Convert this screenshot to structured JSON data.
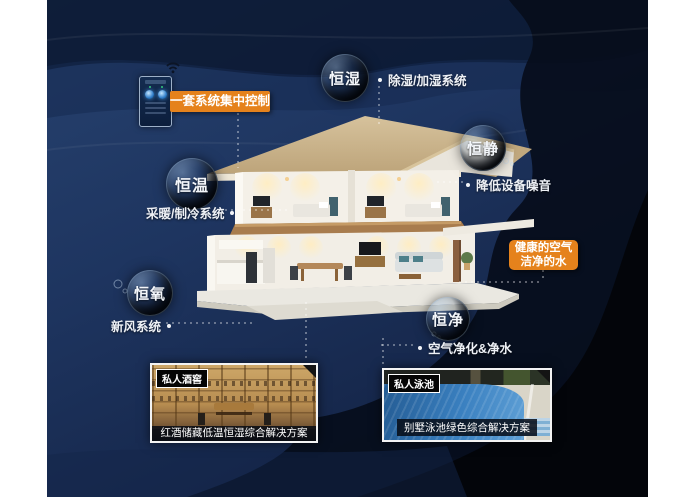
{
  "poster": {
    "control_label": "一套系统集中控制",
    "bubbles": [
      {
        "id": "hengshi",
        "name": "恒湿",
        "desc": "除湿/加湿系统"
      },
      {
        "id": "hengjing",
        "name": "恒静",
        "desc": "降低设备噪音"
      },
      {
        "id": "hengwen",
        "name": "恒温",
        "desc": "采暖/制冷系统"
      },
      {
        "id": "hengyang",
        "name": "恒氧",
        "desc": "新风系统"
      },
      {
        "id": "hengjing2",
        "name": "恒净",
        "desc": "空气净化&净水"
      }
    ],
    "highlight": {
      "line1": "健康的空气",
      "line2": "洁净的水"
    },
    "photos": [
      {
        "tag": "私人酒窖",
        "caption": "红酒储藏低温恒湿综合解决方案"
      },
      {
        "tag": "私人泳池",
        "caption": "别墅泳池绿色综合解决方案"
      }
    ],
    "colors": {
      "background_navy": "#1e3560",
      "band_dark": "#0a1526",
      "accent_orange": "#e5821c",
      "roof_tan": "#cdb790",
      "wood_floor": "#a87c4e",
      "pool_blue": "#3a80c0"
    }
  }
}
